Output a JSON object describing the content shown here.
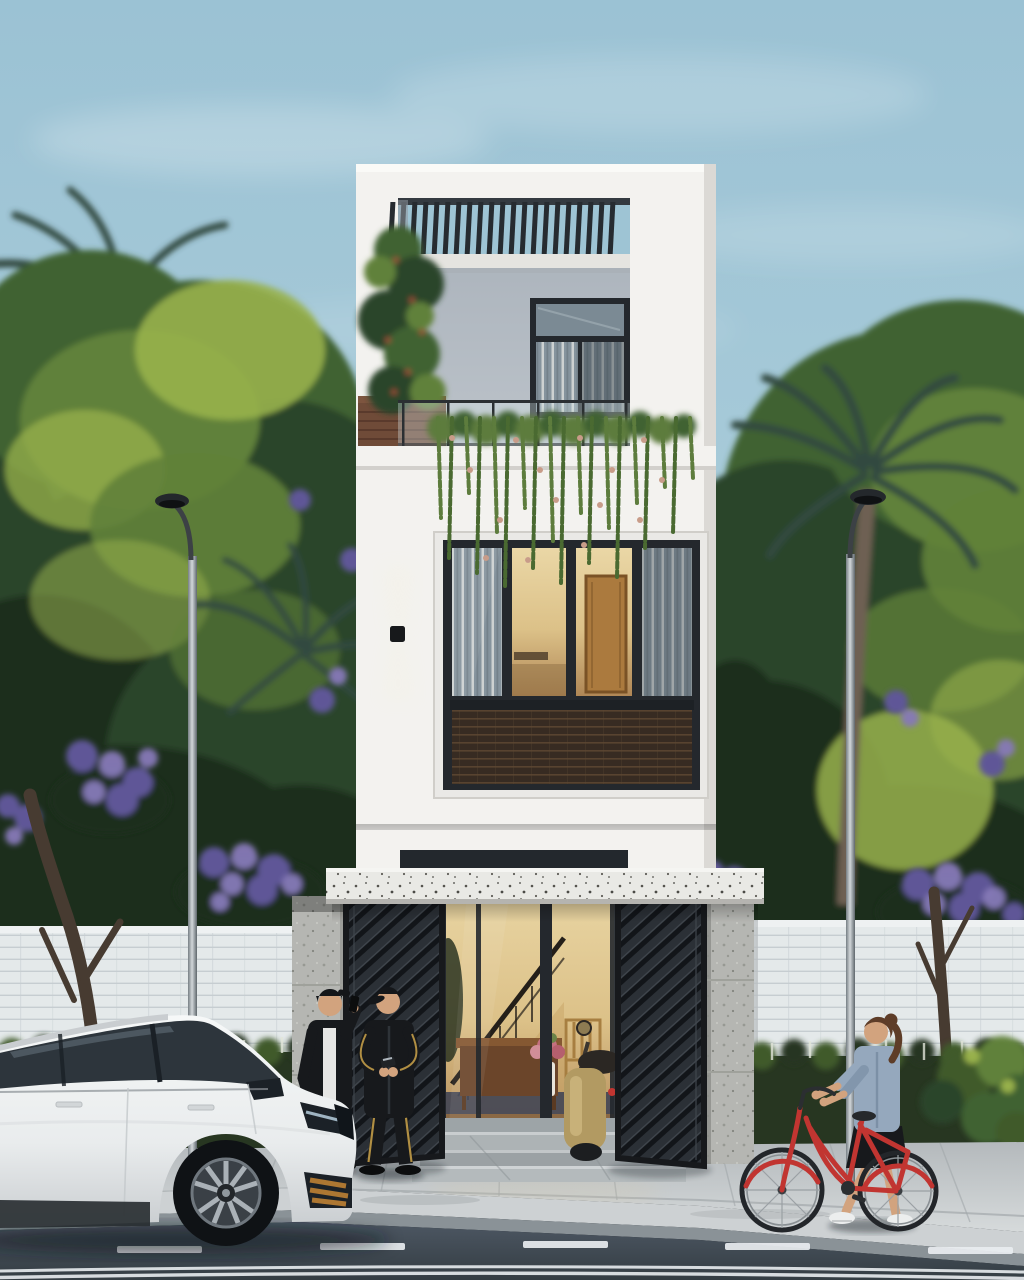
{
  "scene": {
    "setting": "Dusk architectural render: narrow three-storey white modern townhouse between tropical trees, white SUV parked at curb, two men by the open gate, woman walking a red bicycle past the fence",
    "objects": [
      "sky",
      "clouds",
      "tropical-trees",
      "palm-trees",
      "purple-flowering-trees",
      "tree-trunks",
      "white-brick-fence",
      "garden-hedge",
      "street-lamps",
      "house",
      "rooftop-pergola",
      "balcony-railing",
      "wood-planter",
      "climbing-plant",
      "hanging-vines",
      "third-floor-window",
      "second-floor-window",
      "rattan-spandrel",
      "wall-light",
      "terrazzo-canopy",
      "glass-entrance",
      "interior-staircase",
      "interior-furniture",
      "open-metal-gates",
      "stone-pillars",
      "marble-steps",
      "scooter",
      "sidewalk",
      "curb",
      "road",
      "lane-markings",
      "white-suv",
      "man-on-phone",
      "man-in-tracksuit",
      "woman-with-bicycle",
      "red-bicycle"
    ]
  },
  "colors": {
    "sky_top": "#9bc2d4",
    "sky_mid": "#a8cbd9",
    "sky_bottom": "#c6dde4",
    "cloud": "#ffffff",
    "foliage_darkest": "#1b2d1f",
    "foliage_dark": "#2a4529",
    "foliage_mid": "#3f6232",
    "foliage_light": "#61813a",
    "foliage_highlight": "#98b14c",
    "palm_dark": "#31493f",
    "flower_purple": "#5f5697",
    "flower_purple_light": "#867ab8",
    "trunk_dark": "#473b31",
    "palm_trunk": "#6e6052",
    "wall_brick": "#e4e9ea",
    "wall_brick_line": "#c6cdd1",
    "hedge_dark": "#273621",
    "hedge_light": "#3f5a2c",
    "hedge_flower": "#e1e5d9",
    "house_white": "#f3f2ef",
    "house_shade": "#dbd9d5",
    "inner_wall": "#b4bbc2",
    "frame_dark": "#24282d",
    "glass_cool": "#85939d",
    "curtain_light": "#d5d9d7",
    "interior_warm": "#ead7a6",
    "interior_warm_deep": "#b08756",
    "door_wood": "#ab7a3e",
    "woven_dark": "#372b22",
    "woven_line": "#5e4832",
    "planter_wood": "#6f4b38",
    "vine_green": "#5d7c3d",
    "vine_flower": "#c89c89",
    "terrazzo": "#e9e9e5",
    "gate_dark": "#2b3036",
    "gate_slat": "#121519",
    "gate_hi": "#40464d",
    "gate_frame": "#17191c",
    "stone": "#b5b6b2",
    "stone_dark": "#979993",
    "sidewalk": "#c6cbcd",
    "sidewalk_line": "#a2a8ab",
    "curb_top": "#cdd1d3",
    "curb_face": "#8a9297",
    "road": "#4d5763",
    "road_dark": "#343d43",
    "road_mark": "#e9edf0",
    "car_white": "#eef0f0",
    "car_glass": "#2d353c",
    "car_dark": "#1b2127",
    "wheel_silver": "#aab1b7",
    "amber": "#ad7732",
    "bike_red": "#c13531",
    "scooter_gold": "#b29a62",
    "denim": "#95a8bd",
    "skin": "#d2a37e",
    "hair_brown": "#5e3d28",
    "black_cloth": "#17191c",
    "white_cloth": "#e6e6e4",
    "gold_stripe": "#b18f43",
    "lamp_metal": "#9aa2a8",
    "lamp_head": "#24282c",
    "rug_dark": "#3a4054",
    "shadow": "#10151a"
  }
}
